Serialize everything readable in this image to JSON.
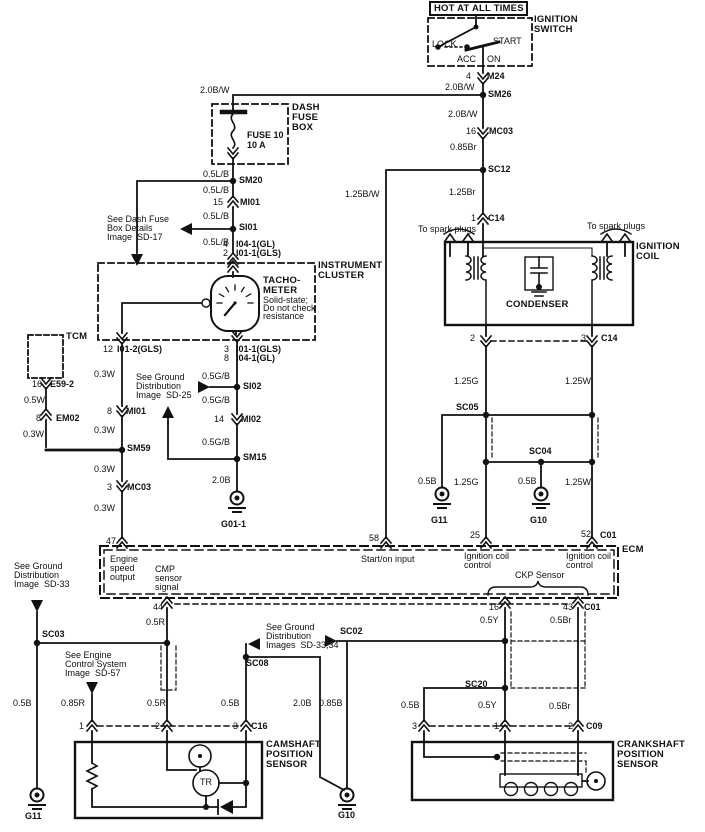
{
  "colors": {
    "background": "#ffffff",
    "ink": "#111111"
  },
  "labels": [
    {
      "id": "hot-at-all-times",
      "text": "HOT AT ALL TIMES",
      "x": 434,
      "y": 4,
      "cls": "t"
    },
    {
      "id": "ignition-switch-1",
      "text": "IGNITION",
      "x": 534,
      "y": 15,
      "cls": "t"
    },
    {
      "id": "ignition-switch-2",
      "text": "SWITCH",
      "x": 534,
      "y": 25,
      "cls": "t"
    },
    {
      "id": "switch-lock",
      "text": "LOCK",
      "x": 432,
      "y": 40
    },
    {
      "id": "switch-start",
      "text": "START",
      "x": 493,
      "y": 37
    },
    {
      "id": "switch-acc",
      "text": "ACC",
      "x": 457,
      "y": 55
    },
    {
      "id": "switch-on",
      "text": "ON",
      "x": 487,
      "y": 55
    },
    {
      "id": "m24-pin-4",
      "text": "4",
      "x": 466,
      "y": 72
    },
    {
      "id": "m24",
      "text": "M24",
      "x": 487,
      "y": 72,
      "cls": "b"
    },
    {
      "id": "wire-20bw-a",
      "text": "2.0B/W",
      "x": 445,
      "y": 83
    },
    {
      "id": "sm26",
      "text": "SM26",
      "x": 488,
      "y": 90,
      "cls": "b"
    },
    {
      "id": "wire-20bw-b",
      "text": "2.0B/W",
      "x": 200,
      "y": 86
    },
    {
      "id": "wire-20bw-c",
      "text": "2.0B/W",
      "x": 448,
      "y": 110
    },
    {
      "id": "mc03-pin-16",
      "text": "16",
      "x": 466,
      "y": 127
    },
    {
      "id": "mc03-a",
      "text": "MC03",
      "x": 489,
      "y": 127,
      "cls": "b"
    },
    {
      "id": "wire-085br",
      "text": "0.85Br",
      "x": 450,
      "y": 143
    },
    {
      "id": "sc12",
      "text": "SC12",
      "x": 488,
      "y": 165,
      "cls": "b"
    },
    {
      "id": "wire-125br",
      "text": "1.25Br",
      "x": 449,
      "y": 188
    },
    {
      "id": "c14-pin-1",
      "text": "1",
      "x": 471,
      "y": 214
    },
    {
      "id": "c14-a",
      "text": "C14",
      "x": 488,
      "y": 214,
      "cls": "b"
    },
    {
      "id": "wire-125bw",
      "text": "1.25B/W",
      "x": 345,
      "y": 190
    },
    {
      "id": "to-spark-plugs-left",
      "text": "To spark plugs",
      "x": 418,
      "y": 225
    },
    {
      "id": "to-spark-plugs-right",
      "text": "To spark plugs",
      "x": 587,
      "y": 222
    },
    {
      "id": "ignition-coil-1",
      "text": "IGNITION",
      "x": 636,
      "y": 242,
      "cls": "t"
    },
    {
      "id": "ignition-coil-2",
      "text": "COIL",
      "x": 636,
      "y": 252,
      "cls": "t"
    },
    {
      "id": "condenser",
      "text": "CONDENSER",
      "x": 506,
      "y": 300,
      "cls": "t"
    },
    {
      "id": "dash-fuse-box-1",
      "text": "DASH",
      "x": 292,
      "y": 103,
      "cls": "t"
    },
    {
      "id": "dash-fuse-box-2",
      "text": "FUSE",
      "x": 292,
      "y": 113,
      "cls": "t"
    },
    {
      "id": "dash-fuse-box-3",
      "text": "BOX",
      "x": 292,
      "y": 123,
      "cls": "t"
    },
    {
      "id": "fuse-10",
      "text": "FUSE 10",
      "x": 247,
      "y": 131,
      "cls": "b"
    },
    {
      "id": "fuse-10-amp",
      "text": "10 A",
      "x": 247,
      "y": 141,
      "cls": "b"
    },
    {
      "id": "wire-05lb-a",
      "text": "0.5L/B",
      "x": 203,
      "y": 170
    },
    {
      "id": "sm20",
      "text": "SM20",
      "x": 239,
      "y": 176,
      "cls": "b"
    },
    {
      "id": "wire-05lb-b",
      "text": "0.5L/B",
      "x": 203,
      "y": 186
    },
    {
      "id": "mi01-pin-15",
      "text": "15",
      "x": 213,
      "y": 198
    },
    {
      "id": "mi01-a",
      "text": "MI01",
      "x": 240,
      "y": 198,
      "cls": "b"
    },
    {
      "id": "wire-05lb-c",
      "text": "0.5L/B",
      "x": 203,
      "y": 212
    },
    {
      "id": "si01",
      "text": "SI01",
      "x": 239,
      "y": 223,
      "cls": "b"
    },
    {
      "id": "see-dash-fuse-1",
      "text": "See Dash Fuse",
      "x": 107,
      "y": 215
    },
    {
      "id": "see-dash-fuse-2",
      "text": "Box Details",
      "x": 107,
      "y": 224
    },
    {
      "id": "see-dash-fuse-3",
      "text": "Image  SD-17",
      "x": 107,
      "y": 233
    },
    {
      "id": "wire-05lb-d",
      "text": "0.5L/B",
      "x": 203,
      "y": 238
    },
    {
      "id": "cluster-pin-4",
      "text": "4",
      "x": 223,
      "y": 240
    },
    {
      "id": "cluster-i04-a",
      "text": "I04-1(GL)",
      "x": 236,
      "y": 240,
      "cls": "b"
    },
    {
      "id": "cluster-pin-2",
      "text": "2",
      "x": 223,
      "y": 249
    },
    {
      "id": "cluster-i01-a",
      "text": "I01-1(GLS)",
      "x": 236,
      "y": 249,
      "cls": "b"
    },
    {
      "id": "instrument-cluster-1",
      "text": "INSTRUMENT",
      "x": 318,
      "y": 261,
      "cls": "t"
    },
    {
      "id": "instrument-cluster-2",
      "text": "CLUSTER",
      "x": 318,
      "y": 271,
      "cls": "t"
    },
    {
      "id": "tachometer-1",
      "text": "TACHO-",
      "x": 263,
      "y": 276,
      "cls": "t"
    },
    {
      "id": "tachometer-2",
      "text": "METER",
      "x": 263,
      "y": 286,
      "cls": "t"
    },
    {
      "id": "tachometer-3",
      "text": "Solid-state;",
      "x": 263,
      "y": 296
    },
    {
      "id": "tachometer-4",
      "text": "Do not check",
      "x": 263,
      "y": 304
    },
    {
      "id": "tachometer-5",
      "text": "resistance",
      "x": 263,
      "y": 312
    },
    {
      "id": "cluster-pin-12",
      "text": "12",
      "x": 103,
      "y": 345
    },
    {
      "id": "cluster-i01-2",
      "text": "I01-2(GLS)",
      "x": 117,
      "y": 345,
      "cls": "b"
    },
    {
      "id": "cluster-pin-3",
      "text": "3",
      "x": 224,
      "y": 345
    },
    {
      "id": "cluster-i01-b",
      "text": "I01-1(GLS)",
      "x": 236,
      "y": 345,
      "cls": "b"
    },
    {
      "id": "cluster-pin-8",
      "text": "8",
      "x": 224,
      "y": 354
    },
    {
      "id": "cluster-i04-b",
      "text": "I04-1(GL)",
      "x": 236,
      "y": 354,
      "cls": "b"
    },
    {
      "id": "tcm",
      "text": "TCM",
      "x": 66,
      "y": 332,
      "cls": "t"
    },
    {
      "id": "e59-pin-16",
      "text": "16",
      "x": 32,
      "y": 380
    },
    {
      "id": "e59-2",
      "text": "E59-2",
      "x": 50,
      "y": 380,
      "cls": "b"
    },
    {
      "id": "wire-05w",
      "text": "0.5W",
      "x": 24,
      "y": 396
    },
    {
      "id": "em02-pin-8",
      "text": "8",
      "x": 36,
      "y": 414
    },
    {
      "id": "em02",
      "text": "EM02",
      "x": 56,
      "y": 414,
      "cls": "b"
    },
    {
      "id": "wire-03w-a",
      "text": "0.3W",
      "x": 94,
      "y": 370
    },
    {
      "id": "mi01-pin-8",
      "text": "8",
      "x": 107,
      "y": 407
    },
    {
      "id": "mi01-b",
      "text": "MI01",
      "x": 126,
      "y": 407,
      "cls": "b"
    },
    {
      "id": "wire-03w-b",
      "text": "0.3W",
      "x": 94,
      "y": 426
    },
    {
      "id": "wire-03w-c",
      "text": "0.3W",
      "x": 23,
      "y": 430
    },
    {
      "id": "sm59",
      "text": "SM59",
      "x": 127,
      "y": 444,
      "cls": "b"
    },
    {
      "id": "wire-03w-d",
      "text": "0.3W",
      "x": 94,
      "y": 465
    },
    {
      "id": "mc03-pin-3",
      "text": "3",
      "x": 107,
      "y": 483
    },
    {
      "id": "mc03-b",
      "text": "MC03",
      "x": 127,
      "y": 483,
      "cls": "b"
    },
    {
      "id": "wire-03w-e",
      "text": "0.3W",
      "x": 94,
      "y": 504
    },
    {
      "id": "see-gd25-1",
      "text": "See Ground",
      "x": 136,
      "y": 373
    },
    {
      "id": "see-gd25-2",
      "text": "Distribution",
      "x": 136,
      "y": 382
    },
    {
      "id": "see-gd25-3",
      "text": "Image  SD-25",
      "x": 136,
      "y": 391
    },
    {
      "id": "wire-05gb-a",
      "text": "0.5G/B",
      "x": 202,
      "y": 372
    },
    {
      "id": "si02",
      "text": "SI02",
      "x": 243,
      "y": 382,
      "cls": "b"
    },
    {
      "id": "wire-05gb-b",
      "text": "0.5G/B",
      "x": 202,
      "y": 396
    },
    {
      "id": "mi02-pin-14",
      "text": "14",
      "x": 214,
      "y": 415
    },
    {
      "id": "mi02",
      "text": "MI02",
      "x": 241,
      "y": 415,
      "cls": "b"
    },
    {
      "id": "wire-05gb-c",
      "text": "0.5G/B",
      "x": 202,
      "y": 438
    },
    {
      "id": "sm15",
      "text": "SM15",
      "x": 243,
      "y": 453,
      "cls": "b"
    },
    {
      "id": "wire-20b-a",
      "text": "2.0B",
      "x": 212,
      "y": 476
    },
    {
      "id": "g01-1",
      "text": "G01-1",
      "x": 221,
      "y": 520,
      "cls": "b"
    },
    {
      "id": "coil-pin-2",
      "text": "2",
      "x": 470,
      "y": 334
    },
    {
      "id": "coil-pin-3",
      "text": "3",
      "x": 581,
      "y": 334
    },
    {
      "id": "c14-b",
      "text": "C14",
      "x": 601,
      "y": 334,
      "cls": "b"
    },
    {
      "id": "wire-125g-a",
      "text": "1.25G",
      "x": 454,
      "y": 377
    },
    {
      "id": "wire-125w-a",
      "text": "1.25W",
      "x": 565,
      "y": 377
    },
    {
      "id": "sc05",
      "text": "SC05",
      "x": 456,
      "y": 403,
      "cls": "b"
    },
    {
      "id": "sc04",
      "text": "SC04",
      "x": 529,
      "y": 447,
      "cls": "b"
    },
    {
      "id": "wire-05b-a",
      "text": "0.5B",
      "x": 418,
      "y": 477
    },
    {
      "id": "wire-125g-b",
      "text": "1.25G",
      "x": 454,
      "y": 478
    },
    {
      "id": "wire-05b-b",
      "text": "0.5B",
      "x": 518,
      "y": 477
    },
    {
      "id": "wire-125w-b",
      "text": "1.25W",
      "x": 565,
      "y": 478
    },
    {
      "id": "g11-a",
      "text": "G11",
      "x": 431,
      "y": 516,
      "cls": "b"
    },
    {
      "id": "g10-a",
      "text": "G10",
      "x": 530,
      "y": 516,
      "cls": "b"
    },
    {
      "id": "ecm-pin-47",
      "text": "47",
      "x": 106,
      "y": 537
    },
    {
      "id": "ecm-pin-58",
      "text": "58",
      "x": 369,
      "y": 534
    },
    {
      "id": "ecm-pin-25",
      "text": "25",
      "x": 470,
      "y": 531
    },
    {
      "id": "ecm-pin-52",
      "text": "52",
      "x": 581,
      "y": 530
    },
    {
      "id": "c01-a",
      "text": "C01",
      "x": 600,
      "y": 531,
      "cls": "b"
    },
    {
      "id": "ecm",
      "text": "ECM",
      "x": 622,
      "y": 545,
      "cls": "t"
    },
    {
      "id": "engine-speed-1",
      "text": "Engine",
      "x": 110,
      "y": 555
    },
    {
      "id": "engine-speed-2",
      "text": "speed",
      "x": 110,
      "y": 564
    },
    {
      "id": "engine-speed-3",
      "text": "output",
      "x": 110,
      "y": 573
    },
    {
      "id": "cmp-signal-1",
      "text": "CMP",
      "x": 155,
      "y": 565
    },
    {
      "id": "cmp-signal-2",
      "text": "sensor",
      "x": 155,
      "y": 574
    },
    {
      "id": "cmp-signal-3",
      "text": "signal",
      "x": 155,
      "y": 583
    },
    {
      "id": "start-on-input",
      "text": "Start/on input",
      "x": 361,
      "y": 555
    },
    {
      "id": "ign-coil-ctrl-1a",
      "text": "Ignition coil",
      "x": 464,
      "y": 552
    },
    {
      "id": "ign-coil-ctrl-1b",
      "text": "control",
      "x": 464,
      "y": 561
    },
    {
      "id": "ign-coil-ctrl-2a",
      "text": "Ignition coil",
      "x": 566,
      "y": 552
    },
    {
      "id": "ign-coil-ctrl-2b",
      "text": "control",
      "x": 566,
      "y": 561
    },
    {
      "id": "ckp-sensor",
      "text": "CKP Sensor",
      "x": 515,
      "y": 571
    },
    {
      "id": "ecm-pin-16",
      "text": "16",
      "x": 489,
      "y": 603
    },
    {
      "id": "ecm-pin-43",
      "text": "43",
      "x": 563,
      "y": 603
    },
    {
      "id": "c01-b",
      "text": "C01",
      "x": 584,
      "y": 603,
      "cls": "b"
    },
    {
      "id": "see-gd33-1",
      "text": "See Ground",
      "x": 14,
      "y": 562
    },
    {
      "id": "see-gd33-2",
      "text": "Distribution",
      "x": 14,
      "y": 571
    },
    {
      "id": "see-gd33-3",
      "text": "Image  SD-33",
      "x": 14,
      "y": 580
    },
    {
      "id": "sc03",
      "text": "SC03",
      "x": 42,
      "y": 630,
      "cls": "b"
    },
    {
      "id": "ecm-pin-44",
      "text": "44",
      "x": 153,
      "y": 603
    },
    {
      "id": "wire-05r-a",
      "text": "0.5R",
      "x": 146,
      "y": 618
    },
    {
      "id": "see-ecs-1",
      "text": "See Engine",
      "x": 65,
      "y": 651
    },
    {
      "id": "see-ecs-2",
      "text": "Control System",
      "x": 65,
      "y": 660
    },
    {
      "id": "see-ecs-3",
      "text": "Image  SD-57",
      "x": 65,
      "y": 669
    },
    {
      "id": "see-gd3334-1",
      "text": "See Ground",
      "x": 266,
      "y": 623
    },
    {
      "id": "see-gd3334-2",
      "text": "Distribution",
      "x": 266,
      "y": 632
    },
    {
      "id": "see-gd3334-3",
      "text": "Images  SD-33,34",
      "x": 266,
      "y": 641
    },
    {
      "id": "sc02",
      "text": "SC02",
      "x": 340,
      "y": 627,
      "cls": "b"
    },
    {
      "id": "sc08",
      "text": "SC08",
      "x": 246,
      "y": 659,
      "cls": "b"
    },
    {
      "id": "wire-05b-c",
      "text": "0.5B",
      "x": 13,
      "y": 699
    },
    {
      "id": "wire-085r",
      "text": "0.85R",
      "x": 61,
      "y": 699
    },
    {
      "id": "wire-05r-b",
      "text": "0.5R",
      "x": 147,
      "y": 699
    },
    {
      "id": "wire-05b-d",
      "text": "0.5B",
      "x": 221,
      "y": 699
    },
    {
      "id": "wire-20b-b",
      "text": "2.0B",
      "x": 293,
      "y": 699
    },
    {
      "id": "wire-085b",
      "text": "0.85B",
      "x": 319,
      "y": 699
    },
    {
      "id": "wire-05y-a",
      "text": "0.5Y",
      "x": 480,
      "y": 616
    },
    {
      "id": "wire-05br-a",
      "text": "0.5Br",
      "x": 550,
      "y": 616
    },
    {
      "id": "sc20",
      "text": "SC20",
      "x": 465,
      "y": 680,
      "cls": "b"
    },
    {
      "id": "wire-05b-e",
      "text": "0.5B",
      "x": 401,
      "y": 701
    },
    {
      "id": "wire-05y-b",
      "text": "0.5Y",
      "x": 478,
      "y": 701
    },
    {
      "id": "wire-05br-b",
      "text": "0.5Br",
      "x": 549,
      "y": 702
    },
    {
      "id": "cmp-pin-1",
      "text": "1",
      "x": 79,
      "y": 722
    },
    {
      "id": "cmp-pin-2",
      "text": "2",
      "x": 155,
      "y": 722
    },
    {
      "id": "cmp-pin-3",
      "text": "3",
      "x": 233,
      "y": 722
    },
    {
      "id": "c16",
      "text": "C16",
      "x": 251,
      "y": 722,
      "cls": "b"
    },
    {
      "id": "camshaft-1",
      "text": "CAMSHAFT",
      "x": 266,
      "y": 740,
      "cls": "t"
    },
    {
      "id": "camshaft-2",
      "text": "POSITION",
      "x": 266,
      "y": 750,
      "cls": "t"
    },
    {
      "id": "camshaft-3",
      "text": "SENSOR",
      "x": 266,
      "y": 760,
      "cls": "t"
    },
    {
      "id": "transistor",
      "text": "TR",
      "x": 200,
      "y": 778
    },
    {
      "id": "ckp-pin-3",
      "text": "3",
      "x": 412,
      "y": 722
    },
    {
      "id": "ckp-pin-1",
      "text": "1",
      "x": 494,
      "y": 722
    },
    {
      "id": "ckp-pin-2",
      "text": "2",
      "x": 568,
      "y": 722
    },
    {
      "id": "c09",
      "text": "C09",
      "x": 586,
      "y": 722,
      "cls": "b"
    },
    {
      "id": "crankshaft-1",
      "text": "CRANKSHAFT",
      "x": 617,
      "y": 740,
      "cls": "t"
    },
    {
      "id": "crankshaft-2",
      "text": "POSITION",
      "x": 617,
      "y": 750,
      "cls": "t"
    },
    {
      "id": "crankshaft-3",
      "text": "SENSOR",
      "x": 617,
      "y": 760,
      "cls": "t"
    },
    {
      "id": "g11-b",
      "text": "G11",
      "x": 25,
      "y": 812,
      "cls": "b"
    },
    {
      "id": "g10-b",
      "text": "G10",
      "x": 338,
      "y": 811,
      "cls": "b"
    }
  ]
}
